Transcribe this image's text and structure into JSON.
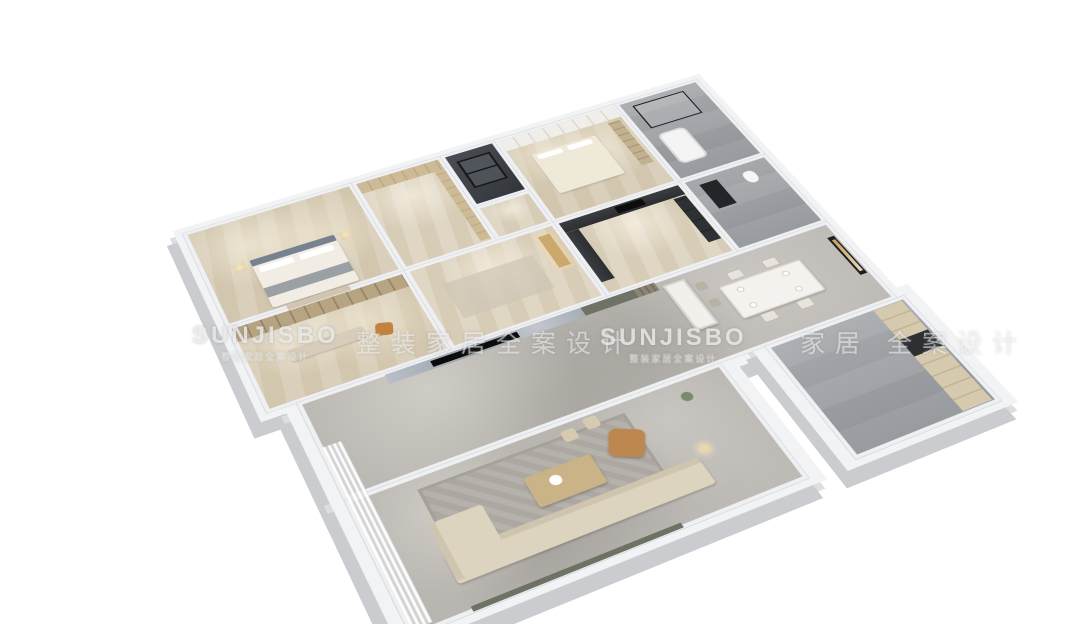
{
  "meta": {
    "kind": "3d-isometric-floorplan-render",
    "background": "#ffffff"
  },
  "watermark": {
    "items": [
      {
        "kind": "logo",
        "text": "SUNJISBO",
        "sub": "整装家居全案设计"
      },
      {
        "kind": "phrase",
        "text": "整装家居全案设计"
      },
      {
        "kind": "logo",
        "text": "SUNJISBO",
        "sub": "整装家居全案设计"
      },
      {
        "kind": "phrase",
        "text": "家居 全案设计"
      }
    ]
  },
  "palette": {
    "background": "#ffffff",
    "wall_top": "#f2f3f5",
    "wall_side": "#caccd0",
    "wood_floor": "#d5c9b2",
    "marble_floor": "#b9b6b1",
    "gray_tile": "#9fa2a6",
    "dark_shaft": "#33363b",
    "kitchen_counter": "#3a3d41",
    "headboard_blue": "#76828f",
    "sofa_beige": "#ddd4c0",
    "armchair_tan": "#bc8850",
    "gold_wood": "#c3a979",
    "art_gold": "#c8a25c"
  },
  "rooms": [
    {
      "id": "master-bedroom"
    },
    {
      "id": "walk-in-closet"
    },
    {
      "id": "elevator-shaft"
    },
    {
      "id": "upper-hallway"
    },
    {
      "id": "second-bedroom"
    },
    {
      "id": "bathroom-top-right"
    },
    {
      "id": "study"
    },
    {
      "id": "foyer"
    },
    {
      "id": "kitchen"
    },
    {
      "id": "bathroom-middle-right"
    },
    {
      "id": "dining-hall"
    },
    {
      "id": "living-room"
    },
    {
      "id": "balcony"
    },
    {
      "id": "utility-wing"
    }
  ]
}
